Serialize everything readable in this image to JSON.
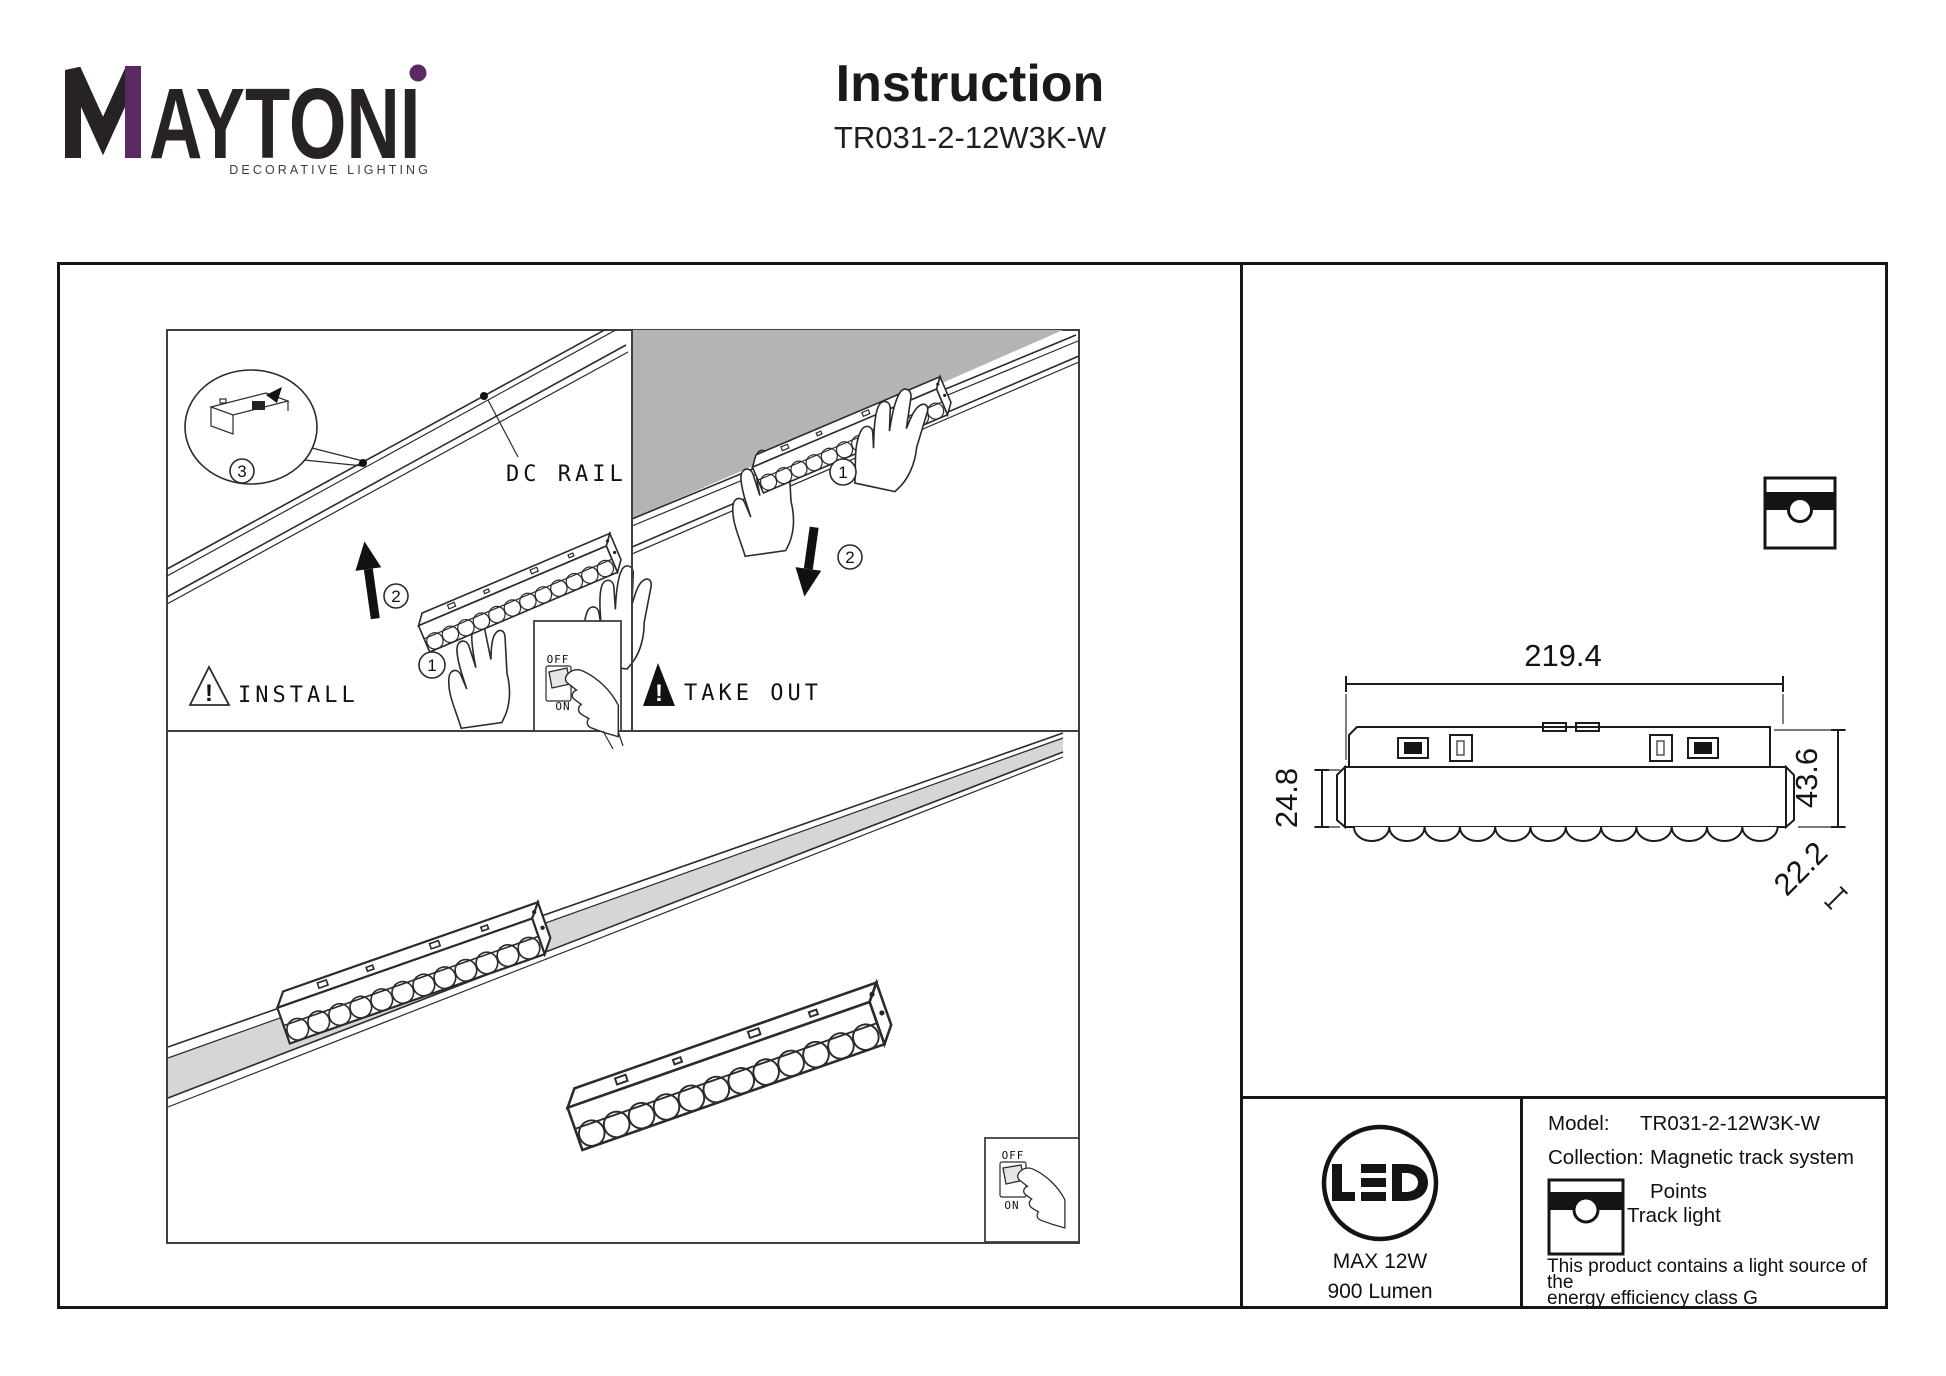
{
  "brand": {
    "logo_rest": "AYTONI",
    "tagline": "DECORATIVE LIGHTING",
    "accent_color": "#5c2a62",
    "text_color": "#262226"
  },
  "header": {
    "title": "Instruction",
    "model": "TR031-2-12W3K-W"
  },
  "illustration": {
    "rail_label": "DC RAIL",
    "install_label": "INSTALL",
    "takeout_label": "TAKE OUT",
    "warning_mark": "!",
    "switch_off": "OFF",
    "switch_on": "ON",
    "step1": "1",
    "step2": "2",
    "step3": "3",
    "ceiling_color": "#b4b4b4",
    "track_channel_color": "#d6d6d6"
  },
  "dimensions": {
    "length": "219.4",
    "height_body": "24.8",
    "height_total": "43.6",
    "width": "22.2"
  },
  "badge": {
    "max_power": "MAX 12W",
    "flux": "900 Lumen"
  },
  "info": {
    "model_label": "Model:",
    "model_value": "TR031-2-12W3K-W",
    "collection_label": "Collection:",
    "collection_value": "Magnetic track system",
    "type_line1": "Points",
    "type_line2": "Track light",
    "energy_note_line1": "This product contains a light source of the",
    "energy_note_line2": "energy efficiency class G"
  }
}
